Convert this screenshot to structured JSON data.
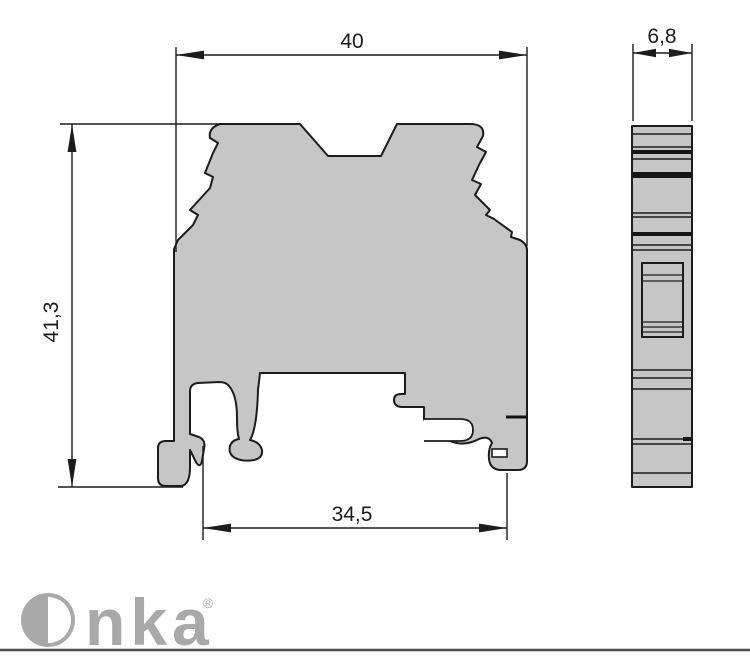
{
  "drawing": {
    "type": "terminal-block-dimension-drawing",
    "views": {
      "front_view": "terminal block side profile with DIN rail mounting foot",
      "side_view": "terminal block narrow edge profile"
    }
  },
  "dimensions": {
    "front_width": {
      "label": "40",
      "orientation": "horizontal",
      "position": "top"
    },
    "front_height": {
      "label": "41,3",
      "orientation": "vertical",
      "position": "left"
    },
    "rail_width": {
      "label": "34,5",
      "orientation": "horizontal",
      "position": "bottom"
    },
    "side_width": {
      "label": "6,8",
      "orientation": "horizontal",
      "position": "top-right"
    }
  },
  "branding": {
    "logo_text": "Onka",
    "logo_tail": "nka",
    "registered_mark": "®"
  },
  "colors": {
    "part_fill": "#c6c6c6",
    "outline": "#1c1c1c",
    "logo_gray": "#a9a9a9",
    "footer_rule": "#4d4d4d",
    "background": "#ffffff"
  }
}
